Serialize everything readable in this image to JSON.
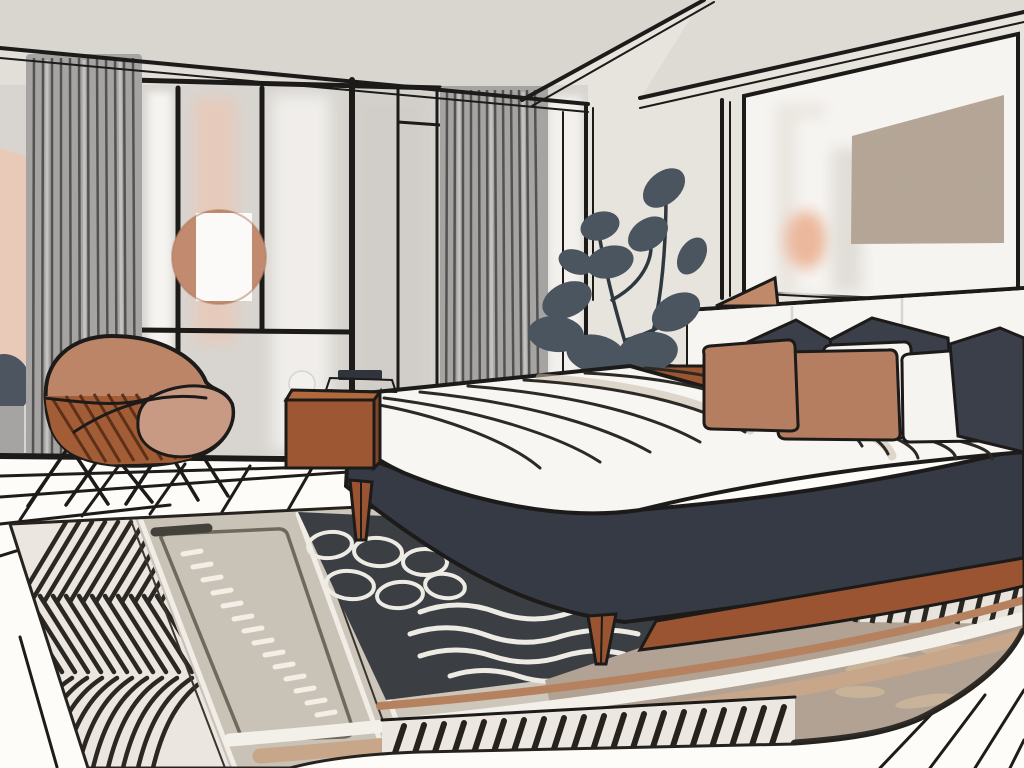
{
  "scene": {
    "title": "Modern bedroom interior illustration",
    "style": "flat vector line-art illustration",
    "objects": [
      "ceiling with black trim lines",
      "window wall with black mullions",
      "two gray pleated curtain panels",
      "round terracotta wall mirror",
      "terracotta accent chair with wire legs",
      "sienna wood nightstand",
      "white ball table lamp",
      "dark tray on nightstand",
      "slate potted plant",
      "platform bed with charcoal base and wood legs",
      "white duvet with contour stripes",
      "pillows: 3 charcoal, 2 white, 2 terracotta",
      "white panel headboard with wall shelf",
      "terracotta wedge decor on shelf",
      "framed textured artwork on paneled wall",
      "layered patterned area rug (zigzag, runner, waves, fringe)",
      "white floor with black perspective lines"
    ],
    "pillow_counts": {
      "charcoal": 3,
      "white": 2,
      "terracotta": 2
    },
    "curtain_panels": 2
  },
  "palette": {
    "outline": "#1c1b19",
    "wall_back": "#e7e3dd",
    "wall_left": "#e2ded8",
    "ceiling": "#d9d5cf",
    "ceiling_right": "#dedad4",
    "glass": "#d8d5d0",
    "glass_bright": "#f6f4f1",
    "glass_shade": "#cfccc7",
    "blush": "#e9c9b8",
    "wall_blob": "#4c5560",
    "curtain": "#a5a4a2",
    "curtain_stripe": "#454442",
    "mirror": "#c28a6f",
    "mirror_white": "#fbfaf8",
    "chair_shell": "#bd8568",
    "chair_cushion": "#c89a83",
    "chair_slats": "#a25d37",
    "nightstand": "#9d5732",
    "nightstand_top": "#b06a3d",
    "nightstand_side": "#7f4526",
    "lamp_white": "#f3f1ee",
    "lamp_dark": "#30343c",
    "plant_leaf": "#4a5560",
    "plant_stem": "#2f373f",
    "box": "#9c5530",
    "box_top": "#b06a3d",
    "bed_base": "#353a44",
    "bed_wood": "#9a5431",
    "duvet": "#f8f6f2",
    "duvet_stripe": "#2d2924",
    "pillow_dark": "#3a3f4a",
    "pillow_white": "#f6f4f0",
    "pillow_terracotta": "#b57e61",
    "headboard": "#f7f5f2",
    "art_mat": "#f6f4f1",
    "art_fill": "#b7a797",
    "shelf_wedge": "#c08a6a",
    "vase_peach": "#ecb79b",
    "floor": "#fdfcf9",
    "floor_line": "#1d1c1a",
    "rug_base": "#cdc6bb",
    "rug_cream": "#ebe7e0",
    "rug_stripe": "#2b2722",
    "runner": "#c9c2b7",
    "runner_dash": "#f3efe7",
    "rug_dark": "#3b3f43",
    "rug_wave": "#edebe4",
    "rug_taupe": "#b1a294",
    "rug_streak": "#cdb69b",
    "band_white": "#f3f0ea",
    "band_tan": "#c7a689",
    "band_terracotta": "#b5815f",
    "fringe_bg": "#ece8e1",
    "patch_bg": "#e8e4dc",
    "edge_dark": "#2e2b27"
  }
}
